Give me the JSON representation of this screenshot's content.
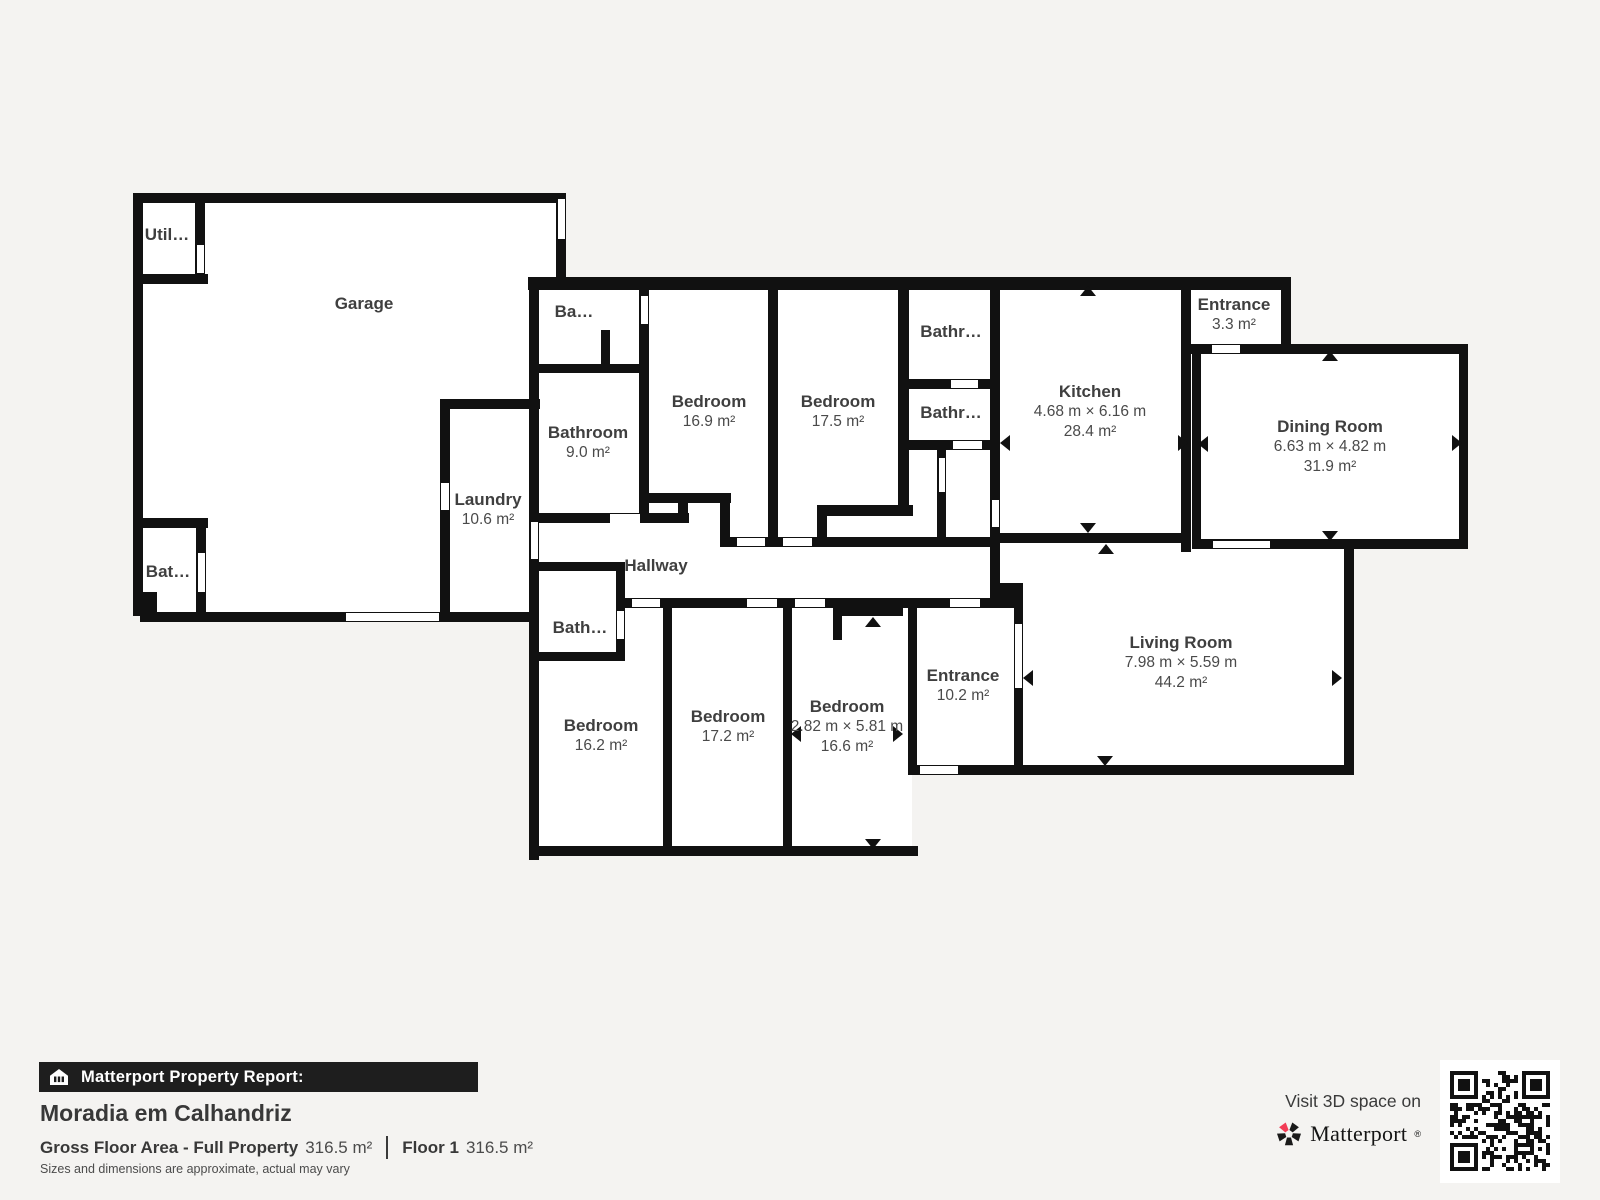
{
  "colors": {
    "background": "#f4f3f1",
    "wall": "#111111",
    "room_fill": "#ffffff",
    "brand_pink": "#f23b55",
    "footer_bar": "#1e1e1e"
  },
  "rooms": [
    {
      "name": "Util…",
      "x": 167,
      "y": 236
    },
    {
      "name": "Garage",
      "x": 364,
      "y": 305
    },
    {
      "name": "Ba…",
      "x": 574,
      "y": 313
    },
    {
      "name": "Bathroom",
      "area": "9.0 m²",
      "x": 588,
      "y": 434
    },
    {
      "name": "Bedroom",
      "area": "16.9 m²",
      "x": 709,
      "y": 403
    },
    {
      "name": "Bedroom",
      "area": "17.5 m²",
      "x": 838,
      "y": 403
    },
    {
      "name": "Bathr…",
      "x": 951,
      "y": 333
    },
    {
      "name": "Bathr…",
      "x": 951,
      "y": 414
    },
    {
      "name": "Kitchen",
      "dims": "4.68 m × 6.16 m",
      "area": "28.4 m²",
      "x": 1090,
      "y": 393
    },
    {
      "name": "Entrance",
      "area": "3.3 m²",
      "x": 1234,
      "y": 306
    },
    {
      "name": "Dining Room",
      "dims": "6.63 m × 4.82 m",
      "area": "31.9 m²",
      "x": 1330,
      "y": 428
    },
    {
      "name": "Laundry",
      "area": "10.6 m²",
      "x": 488,
      "y": 501
    },
    {
      "name": "Bat…",
      "x": 168,
      "y": 573
    },
    {
      "name": "Hallway",
      "x": 656,
      "y": 567
    },
    {
      "name": "Bath…",
      "x": 580,
      "y": 629
    },
    {
      "name": "Bedroom",
      "area": "16.2 m²",
      "x": 601,
      "y": 727
    },
    {
      "name": "Bedroom",
      "area": "17.2 m²",
      "x": 728,
      "y": 718
    },
    {
      "name": "Bedroom",
      "dims": "2.82 m × 5.81 m",
      "area": "16.6 m²",
      "x": 847,
      "y": 708
    },
    {
      "name": "Entrance",
      "area": "10.2 m²",
      "x": 963,
      "y": 677
    },
    {
      "name": "Living Room",
      "dims": "7.98 m × 5.59 m",
      "area": "44.2 m²",
      "x": 1181,
      "y": 644
    }
  ],
  "report": {
    "bar_label": "Matterport Property Report:",
    "property_name": "Moradia em Calhandriz",
    "gross_label": "Gross Floor Area - Full Property",
    "gross_value": "316.5 m²",
    "floor_label": "Floor 1",
    "floor_value": "316.5 m²",
    "disclaimer": "Sizes and dimensions are approximate, actual may vary"
  },
  "cta": {
    "visit_text": "Visit 3D space on",
    "brand": "Matterport",
    "brand_mark": "®"
  }
}
